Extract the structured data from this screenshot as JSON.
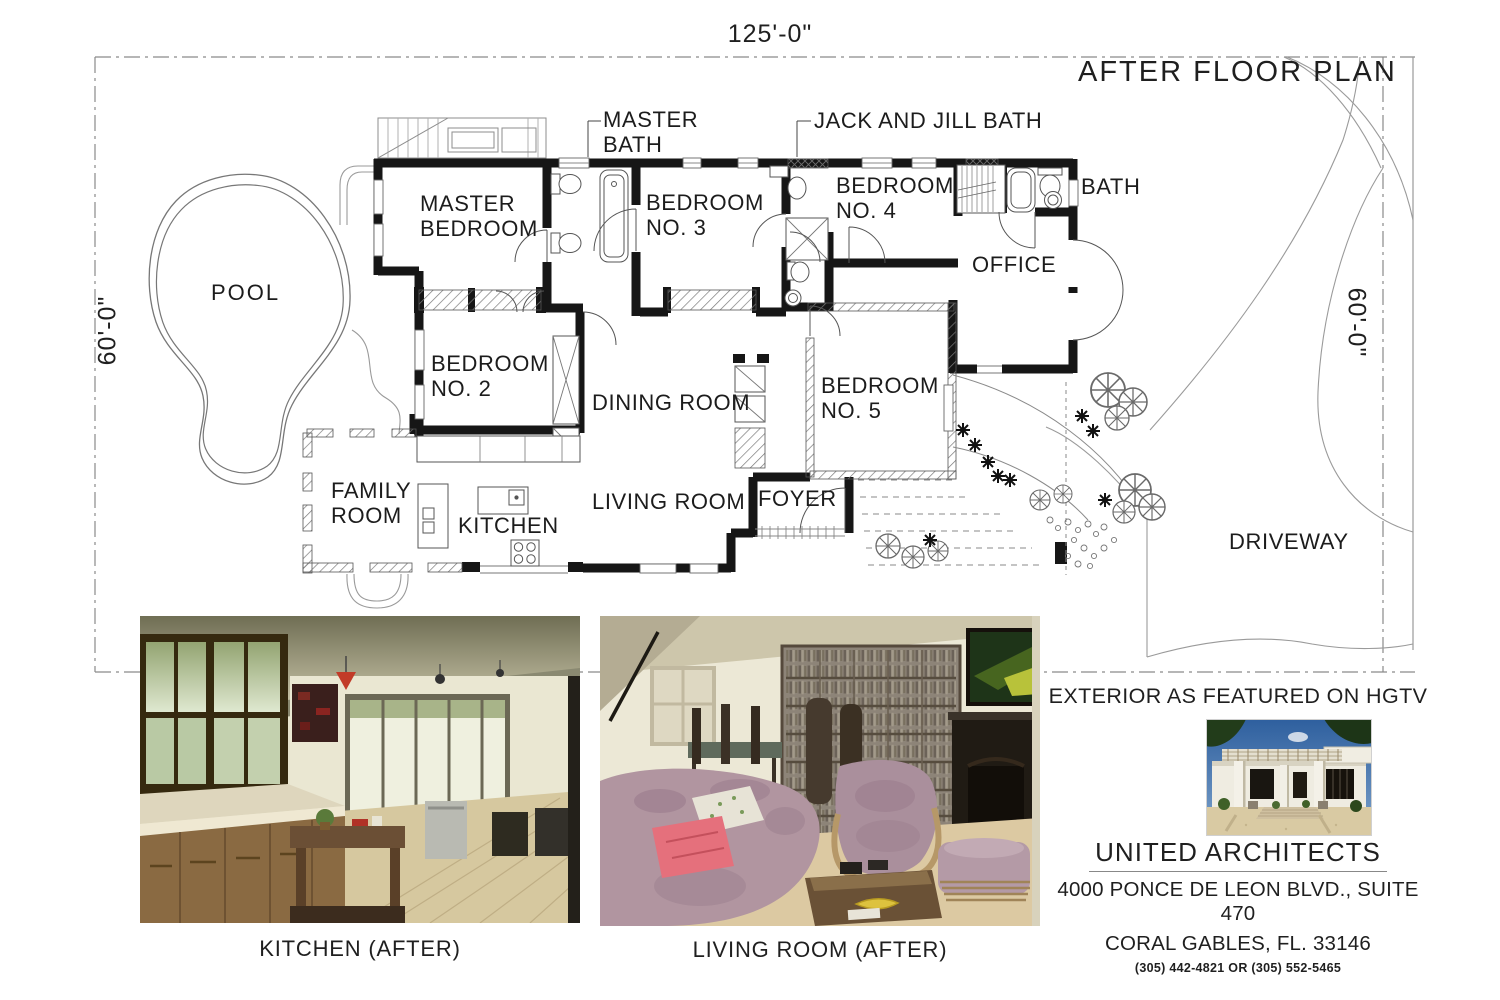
{
  "document": {
    "title": "AFTER FLOOR PLAN",
    "dimensions": {
      "top": "125'-0\"",
      "left": "60'-0\"",
      "right": "60'-0\""
    }
  },
  "plan": {
    "rooms": [
      {
        "id": "master-bedroom",
        "label": "MASTER\nBEDROOM"
      },
      {
        "id": "master-bath",
        "label": "MASTER\nBATH"
      },
      {
        "id": "bedroom-3",
        "label": "BEDROOM\nNO. 3"
      },
      {
        "id": "jack-and-jill-bath",
        "label": "JACK AND JILL BATH"
      },
      {
        "id": "bedroom-4",
        "label": "BEDROOM\nNO. 4"
      },
      {
        "id": "bath",
        "label": "BATH"
      },
      {
        "id": "office",
        "label": "OFFICE"
      },
      {
        "id": "bedroom-2",
        "label": "BEDROOM\nNO. 2"
      },
      {
        "id": "dining-room",
        "label": "DINING ROOM"
      },
      {
        "id": "bedroom-5",
        "label": "BEDROOM\nNO. 5"
      },
      {
        "id": "family-room",
        "label": "FAMILY\nROOM"
      },
      {
        "id": "kitchen",
        "label": "KITCHEN"
      },
      {
        "id": "living-room",
        "label": "LIVING ROOM"
      },
      {
        "id": "foyer",
        "label": "FOYER"
      }
    ],
    "site": {
      "pool": "POOL",
      "driveway": "DRIVEWAY"
    }
  },
  "photos": {
    "kitchen": {
      "caption": "KITCHEN (AFTER)"
    },
    "living_room": {
      "caption": "LIVING ROOM (AFTER)"
    },
    "exterior": {
      "heading": "EXTERIOR AS FEATURED ON HGTV"
    }
  },
  "firm": {
    "name": "UNITED ARCHITECTS",
    "address_line1": "4000 PONCE DE LEON BLVD., SUITE 470",
    "address_line2": "CORAL GABLES, FL. 33146",
    "phone": "(305) 442-4821 OR (305) 552-5465"
  },
  "colors": {
    "paper": "#ffffff",
    "ink": "#1f1f1f",
    "wall": "#161616",
    "plan_line": "#8a8a8a"
  }
}
